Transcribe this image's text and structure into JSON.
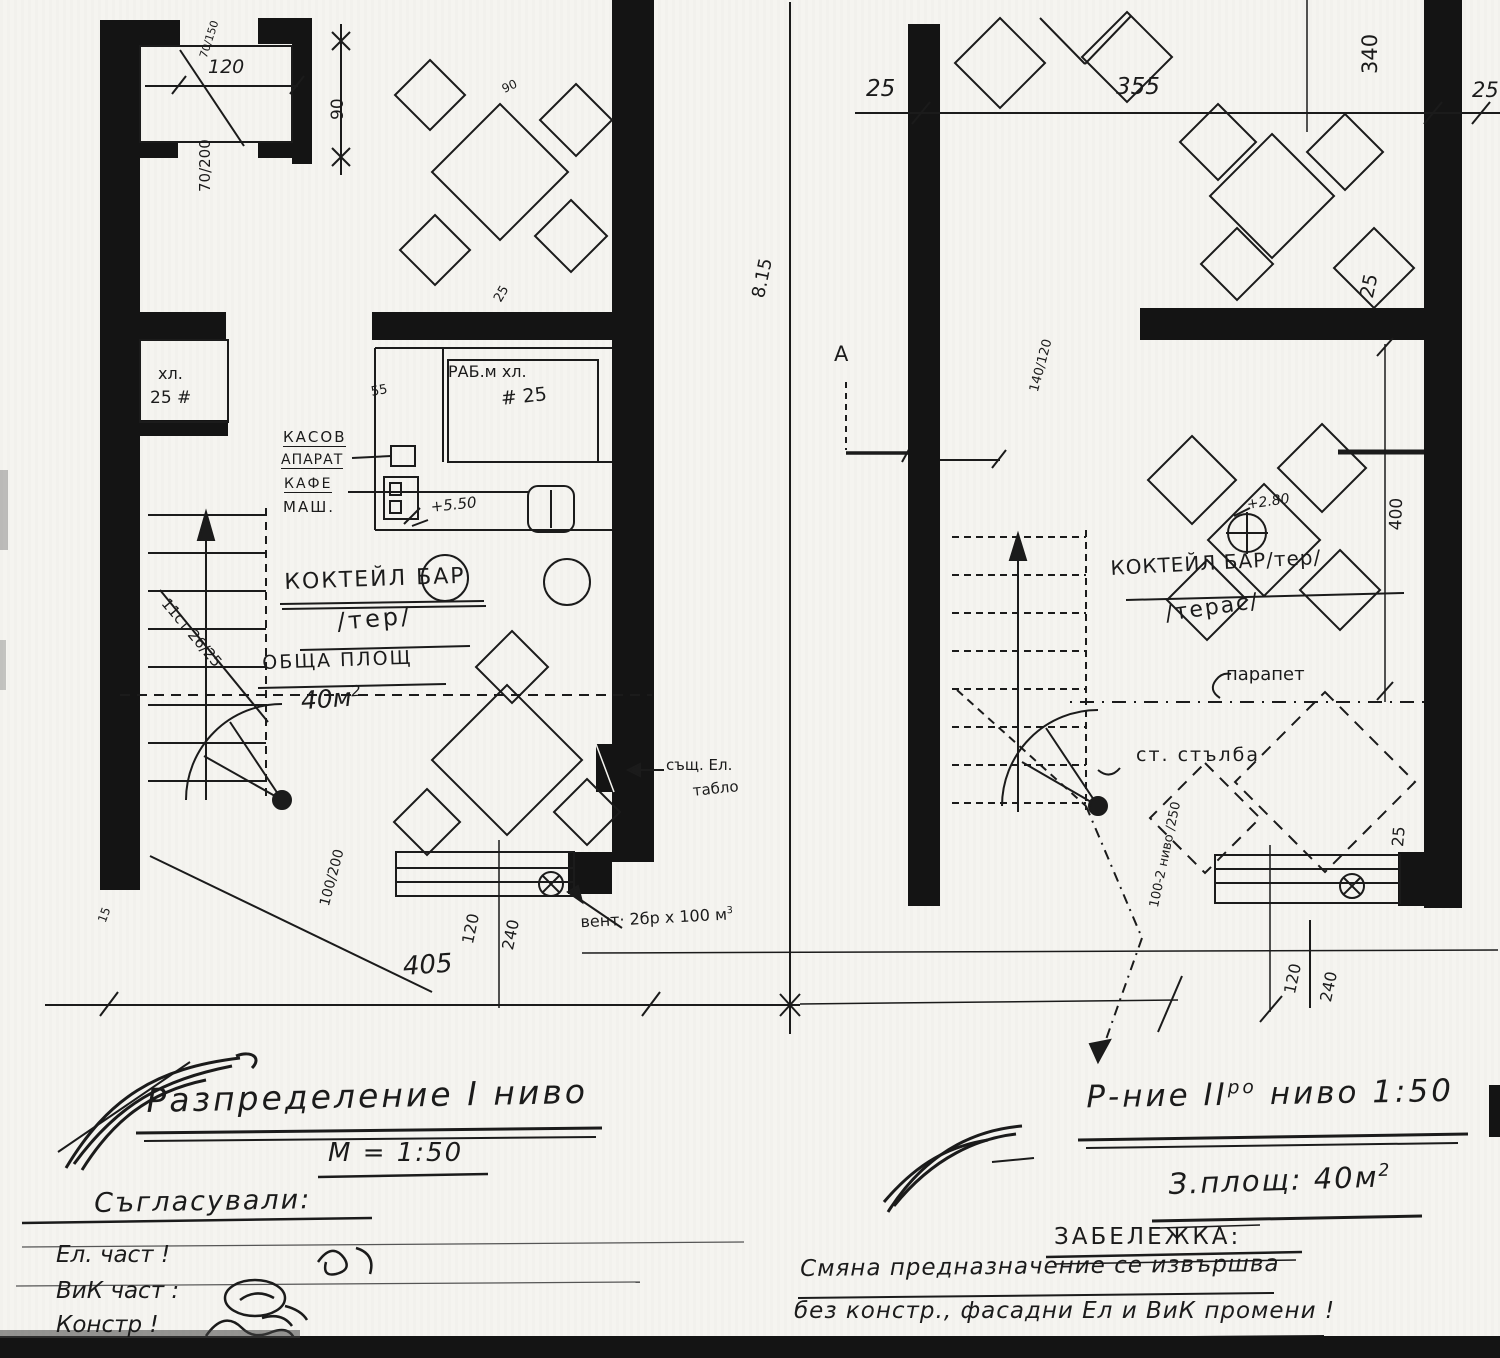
{
  "colors": {
    "paper": "#f5f4f0",
    "ink": "#1b1b1b",
    "wall": "#141414"
  },
  "left_plan": {
    "title": "КОКТЕЙЛ БАР",
    "title_sub": "/тер/",
    "area_label": "ОБЩА ПЛОЩ",
    "area_value": "40м",
    "area_sup": "2",
    "room_small_1": "хл.",
    "room_small_2": "25 #",
    "work_label": "РАБ.м хл.",
    "work_value": "# 25",
    "counter_dim": "55",
    "cash_1": "КАСОВ",
    "cash_2": "АПАРАТ",
    "cash_3": "КАФЕ",
    "cash_4": "МАШ.",
    "level": "+5.50",
    "stair_note": "11ст 26/25",
    "panel_1": "същ. Ел.",
    "panel_2": "табло",
    "vent_note": "вент· 2бр х 100 м",
    "vent_sup": "3",
    "section_mark": "А",
    "dims": {
      "door_spec2": "70/150",
      "door_w": "120",
      "door_h": "90",
      "door_spec": "70/200",
      "w_100_200": "100/200",
      "w_120": "120",
      "w_240": "240",
      "total_w": "405",
      "wall_15": "15",
      "table_25": "25",
      "table_90": "90",
      "height": "8.15"
    }
  },
  "right_plan": {
    "title": "КОКТЕЙЛ БАР/тер/",
    "title_sub": "/терас/",
    "parapet": "парапет",
    "stair_label": "ст. стълба",
    "level": "+2.80",
    "dims": {
      "left_25": "25",
      "mid_355": "355",
      "v_340": "340",
      "right_25": "25",
      "diamond_25": "25",
      "frac_140_120": "140/120",
      "v_400": "400",
      "stair_frac": "100-2 ниво /250",
      "w_120": "120",
      "w_240": "240",
      "b_25": "25"
    }
  },
  "footer_left": {
    "title": "Разпределение I ниво",
    "scale": "М = 1:50",
    "approved": "Съгласували:",
    "row_el": "Ел. част !",
    "row_vik": "ВиК част :",
    "row_constr": "Констр !"
  },
  "footer_right": {
    "title_prefix": "Р-ние II",
    "title_sup": "ро",
    "title_suffix": " ниво 1:50",
    "area_label": "З.площ: 40м",
    "area_sup": "2",
    "note_heading": "ЗАБЕЛЕЖКА:",
    "note_line1": "Смяна предназначение се извършва",
    "note_line2": "без констр., фасадни Ел и ВиК промени !"
  }
}
